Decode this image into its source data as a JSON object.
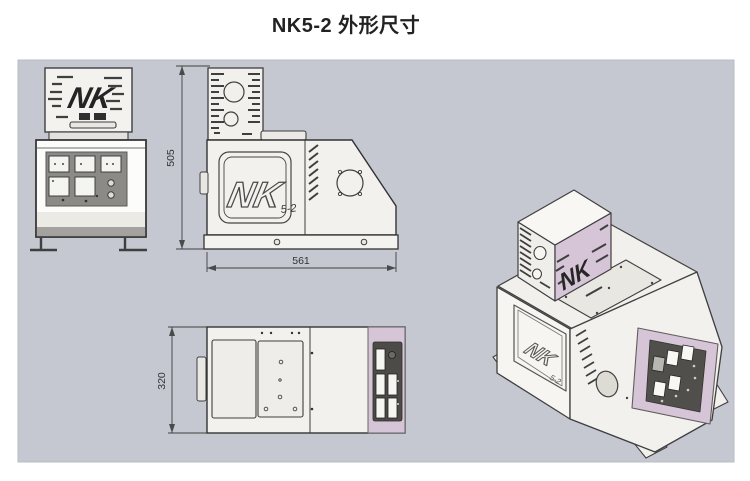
{
  "page": {
    "title": "NK5-2 外形尺寸"
  },
  "branding": {
    "logo": "NK",
    "model": "5-2"
  },
  "dimensions": {
    "height": "505",
    "width": "561",
    "depth": "320"
  },
  "colors": {
    "canvas": "#c5c8d1",
    "accent_lavender": "#d6c4d7",
    "panel_dark": "#4c4b47",
    "body_white": "#f4f3f0"
  }
}
